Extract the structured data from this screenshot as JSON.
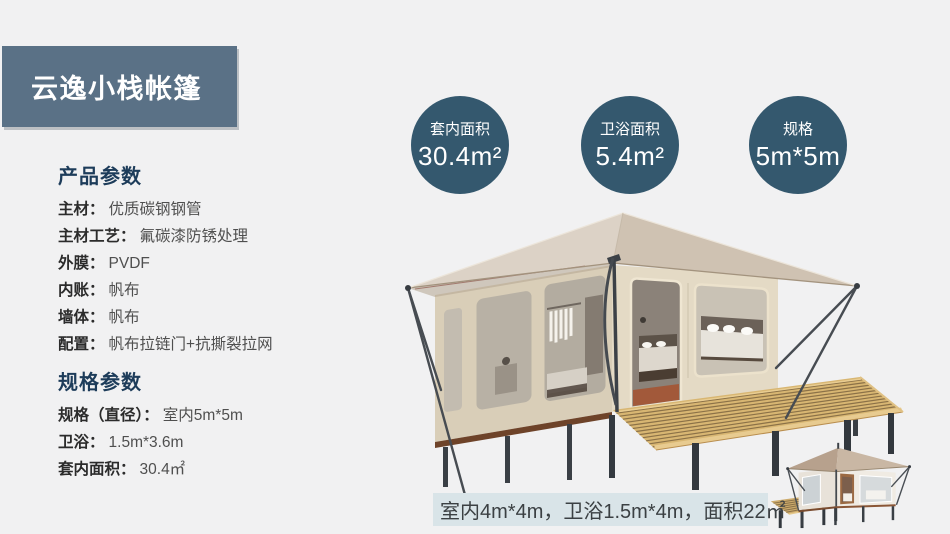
{
  "colors": {
    "page-bg": "#f1f1f2",
    "banner-bg": "#5a7186",
    "banner-text": "#ffffff",
    "circle-bg": "#34586e",
    "circle-text": "#ffffff",
    "heading": "#1d3c5a",
    "label": "#2b2b2b",
    "value": "#4f4f4f",
    "footnote-bg": "#d9e4e8",
    "footnote-text": "#3b4043"
  },
  "banner": {
    "title": "云逸小栈帐篷"
  },
  "stats": [
    {
      "label": "套内面积",
      "value": "30.4m²"
    },
    {
      "label": "卫浴面积",
      "value": "5.4m²"
    },
    {
      "label": "规格",
      "value": "5m*5m"
    }
  ],
  "product_params": {
    "heading": "产品参数",
    "rows": [
      {
        "label": "主材：",
        "value": "优质碳钢钢管"
      },
      {
        "label": "主材工艺：",
        "value": "氟碳漆防锈处理"
      },
      {
        "label": "外膜：",
        "value": "PVDF"
      },
      {
        "label": "内账：",
        "value": "帆布"
      },
      {
        "label": "墙体：",
        "value": "帆布"
      },
      {
        "label": "配置：",
        "value": "帆布拉链门+抗撕裂拉网"
      }
    ]
  },
  "spec_params": {
    "heading": "规格参数",
    "rows": [
      {
        "label": "规格（直径）：",
        "value": "室内5m*5m"
      },
      {
        "label": "卫浴：",
        "value": "1.5m*3.6m"
      },
      {
        "label": "套内面积：",
        "value": "30.4㎡"
      }
    ]
  },
  "footnote": {
    "text": "室内4m*4m，卫浴1.5m*4m，面积22㎡"
  }
}
